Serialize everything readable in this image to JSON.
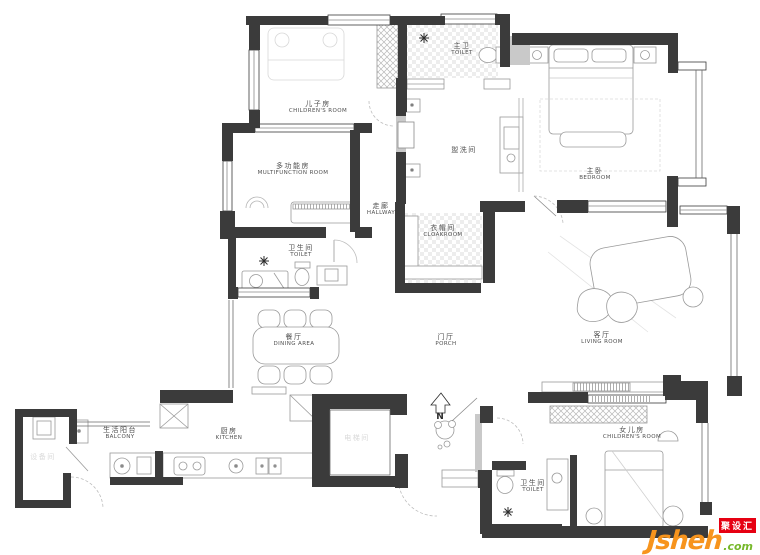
{
  "colors": {
    "wall": "#3b3b3b",
    "watermark_red": "#e60012",
    "watermark_orange": "#f7941d",
    "watermark_green": "#76b82a"
  },
  "compass": {
    "label": "N"
  },
  "icons": {
    "ceiling_light": "✳",
    "north_arrow": "⌂"
  },
  "watermark": {
    "brand": "Jsheh",
    "tld": ".com",
    "cn": "聚设汇"
  },
  "rooms": [
    {
      "zh": "儿子房",
      "en": "CHILDREN'S ROOM"
    },
    {
      "zh": "多功能房",
      "en": "MULTIFUNCTION ROOM"
    },
    {
      "zh": "主卫",
      "en": "TOILET"
    },
    {
      "zh": "盥洗间",
      "en": ""
    },
    {
      "zh": "主卧",
      "en": "BEDROOM"
    },
    {
      "zh": "走廊",
      "en": "HALLWAY"
    },
    {
      "zh": "衣帽间",
      "en": "CLOAKROOM"
    },
    {
      "zh": "卫生间",
      "en": "TOILET"
    },
    {
      "zh": "餐厅",
      "en": "DINING AREA"
    },
    {
      "zh": "门厅",
      "en": "PORCH"
    },
    {
      "zh": "客厅",
      "en": "LIVING ROOM"
    },
    {
      "zh": "生活阳台",
      "en": "BALCONY"
    },
    {
      "zh": "厨房",
      "en": "KITCHEN"
    },
    {
      "zh": "女儿房",
      "en": "CHILDREN'S ROOM"
    },
    {
      "zh": "卫生间",
      "en": "TOILET"
    },
    {
      "zh": "设备间",
      "en": ""
    },
    {
      "zh": "电梯间",
      "en": ""
    }
  ]
}
